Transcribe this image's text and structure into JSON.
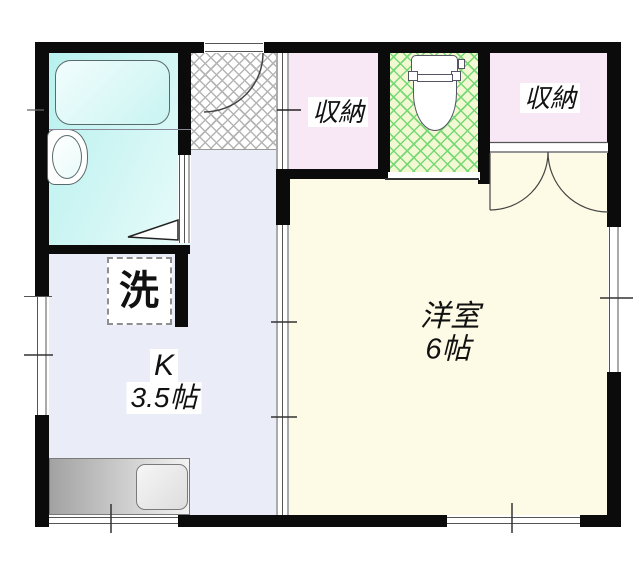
{
  "plan": {
    "type": "apartment-floorplan",
    "rooms": {
      "kitchen": {
        "label": "K",
        "size": "3.5帖"
      },
      "western_room": {
        "label": "洋室",
        "size": "6帖"
      },
      "storage_entrance": {
        "label": "収納"
      },
      "storage_room": {
        "label": "収納"
      },
      "laundry": {
        "label": "洗"
      }
    },
    "colors": {
      "wall": "#0b0b0b",
      "bathroom_floor": "#c3f3f1",
      "kitchen_floor": "#eaecf7",
      "room_floor": "#fdfbe5",
      "storage_floor": "#f8e7f5",
      "toilet_floor": "#f2f8d2",
      "toilet_hatch_line": "#76d976",
      "entrance_hatch_line": "#b5b5b5"
    }
  }
}
